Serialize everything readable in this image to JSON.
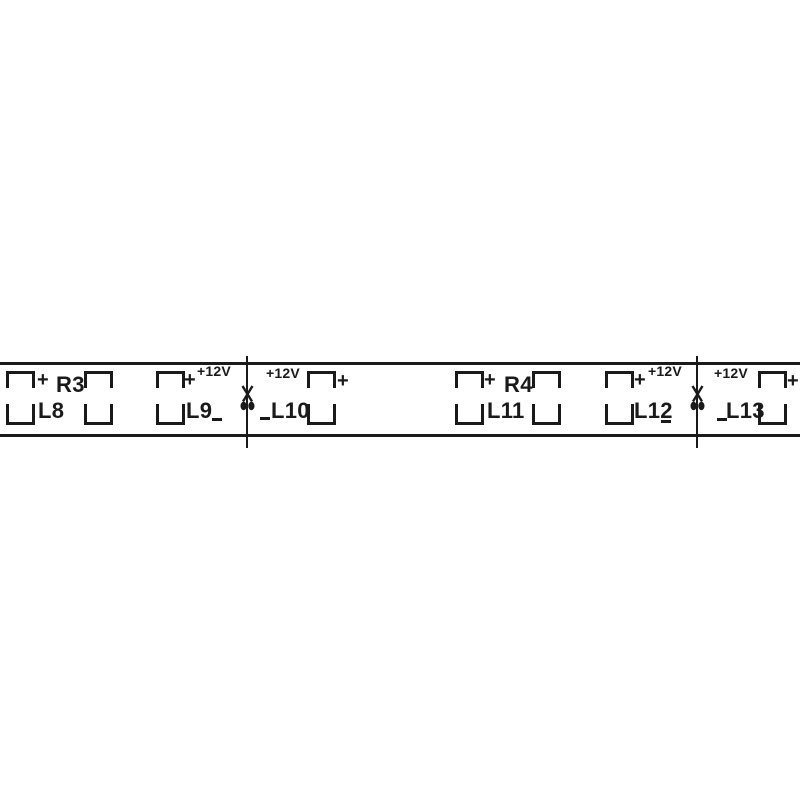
{
  "diagram": {
    "description": "12V LED strip PCB segment drawing",
    "ink_color": "#1a1a1a",
    "background_color": "#ffffff"
  },
  "strip": {
    "left": 0,
    "width": 800,
    "top_edge_y": 362,
    "bottom_edge_y": 434,
    "edge_thickness": 2.5
  },
  "pad_geometry": {
    "width": 29,
    "top_bracket_y": 371,
    "top_bracket_h": 17,
    "bottom_bracket_y": 404,
    "bottom_bracket_h": 21,
    "stroke": 3
  },
  "footprints": [
    {
      "ref": "L8",
      "type": "led",
      "x": 6
    },
    {
      "ref": "R3",
      "type": "resistor",
      "x": 84
    },
    {
      "ref": "L9",
      "type": "led",
      "x": 156
    },
    {
      "ref": "L10",
      "type": "led",
      "x": 307
    },
    {
      "ref": "L11",
      "type": "led",
      "x": 455
    },
    {
      "ref": "R4",
      "type": "resistor",
      "x": 532
    },
    {
      "ref": "L12",
      "type": "led",
      "x": 605
    },
    {
      "ref": "L13",
      "type": "led",
      "x": 758
    }
  ],
  "labels": [
    {
      "text": "L8",
      "kind": "ref",
      "x": 38,
      "y": 400
    },
    {
      "text": "R3",
      "kind": "ref",
      "x": 56,
      "y": 374
    },
    {
      "text": "L9",
      "kind": "ref",
      "x": 186,
      "y": 400
    },
    {
      "text": "L10",
      "kind": "ref",
      "x": 271,
      "y": 400
    },
    {
      "text": "L11",
      "kind": "ref",
      "x": 487,
      "y": 400
    },
    {
      "text": "R4",
      "kind": "ref",
      "x": 504,
      "y": 374
    },
    {
      "text": "L12",
      "kind": "ref",
      "x": 634,
      "y": 400
    },
    {
      "text": "L13",
      "kind": "ref",
      "x": 726,
      "y": 400
    },
    {
      "text": "+12V",
      "kind": "voltage",
      "x": 197,
      "y": 364
    },
    {
      "text": "+12V",
      "kind": "voltage",
      "x": 266,
      "y": 366
    },
    {
      "text": "+12V",
      "kind": "voltage",
      "x": 648,
      "y": 364
    },
    {
      "text": "+12V",
      "kind": "voltage",
      "x": 714,
      "y": 366
    },
    {
      "text": "+",
      "kind": "plus",
      "x": 37,
      "y": 370
    },
    {
      "text": "+",
      "kind": "plus",
      "x": 184,
      "y": 370
    },
    {
      "text": "+",
      "kind": "plus",
      "x": 337,
      "y": 371
    },
    {
      "text": "+",
      "kind": "plus",
      "x": 484,
      "y": 370
    },
    {
      "text": "+",
      "kind": "plus",
      "x": 634,
      "y": 370
    },
    {
      "text": "+",
      "kind": "plus",
      "x": 787,
      "y": 371
    }
  ],
  "minus_marks": [
    {
      "text": "−",
      "x": 212,
      "y": 418
    },
    {
      "text": "−",
      "x": 260,
      "y": 417
    },
    {
      "text": "−",
      "x": 661,
      "y": 420
    },
    {
      "text": "−",
      "x": 717,
      "y": 418
    }
  ],
  "cut_marks": [
    {
      "x": 246,
      "top": 356,
      "bottom": 448,
      "scissors_y": 385
    },
    {
      "x": 696,
      "top": 356,
      "bottom": 448,
      "scissors_y": 385
    }
  ]
}
